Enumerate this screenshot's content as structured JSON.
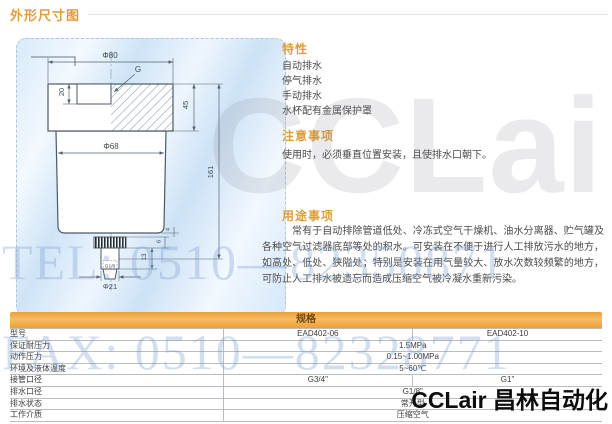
{
  "page_title": "外形尺寸图",
  "drawing": {
    "dims": {
      "top_diameter": "Φ80",
      "thread": "G",
      "thread_depth": "20",
      "head_height": "45",
      "body_diameter": "Φ68",
      "total_height": "161",
      "stem_height": "13",
      "knurl_height": "6",
      "gap": "4",
      "drain_thread": "G1/8",
      "bottom_diameter": "Φ21"
    }
  },
  "sections": {
    "features": {
      "title": "特性",
      "items": [
        "自动排水",
        "停气排水",
        "手动排水",
        "水杯配有金属保护罩"
      ]
    },
    "notes": {
      "title": "注意事项",
      "body": "使用时，必须垂直位置安装，且使排水口朝下。"
    },
    "usage": {
      "title": "用途事项",
      "body": "常有于自动排除管道低处、冷冻式空气干燥机、油水分离器、贮气罐及各种空气过滤器底部等处的积水。可安装在不便于进行人工排放污水的地方，如高处、低处、狭隘处；特别是安装在用气量较大、放水次数较频繁的地方，可防止人工排水被遗忘而造成压缩空气被冷凝水重新污染。"
    }
  },
  "spec_table": {
    "title": "规格",
    "rows": [
      {
        "cells": [
          {
            "t": "型号",
            "s": 1
          },
          {
            "t": "EAD402-06",
            "s": 1
          },
          {
            "t": "EAD402-10",
            "s": 1
          }
        ]
      },
      {
        "cells": [
          {
            "t": "保证耐压力",
            "s": 1
          },
          {
            "t": "1.5MPa",
            "s": 2
          }
        ]
      },
      {
        "cells": [
          {
            "t": "动作压力",
            "s": 1
          },
          {
            "t": "0.15~1.00MPa",
            "s": 2
          }
        ]
      },
      {
        "cells": [
          {
            "t": "环境及液体温度",
            "s": 1
          },
          {
            "t": "5~60℃",
            "s": 2
          }
        ]
      },
      {
        "cells": [
          {
            "t": "接管口径",
            "s": 1
          },
          {
            "t": "G3/4\"",
            "s": 1
          },
          {
            "t": "G1\"",
            "s": 1
          }
        ]
      },
      {
        "cells": [
          {
            "t": "排水口径",
            "s": 1
          },
          {
            "t": "G1/8\"",
            "s": 2
          }
        ]
      },
      {
        "cells": [
          {
            "t": "排水状态",
            "s": 1
          },
          {
            "t": "常开型",
            "s": 2
          }
        ]
      },
      {
        "cells": [
          {
            "t": "工作介质",
            "s": 1
          },
          {
            "t": "压缩空气",
            "s": 2
          }
        ]
      }
    ]
  },
  "watermarks": {
    "brand": "CCLair",
    "tel": "TEL: 0510—82350871",
    "fax": "FAX: 0510—82328771"
  },
  "footer_logo": "CCLair 昌林自动化",
  "colors": {
    "accent_orange": "#dd9e3c",
    "table_bar_orange": "#eda033",
    "panel_blue": "#d2e6f7",
    "watermark_blue": "#7a9ace"
  }
}
